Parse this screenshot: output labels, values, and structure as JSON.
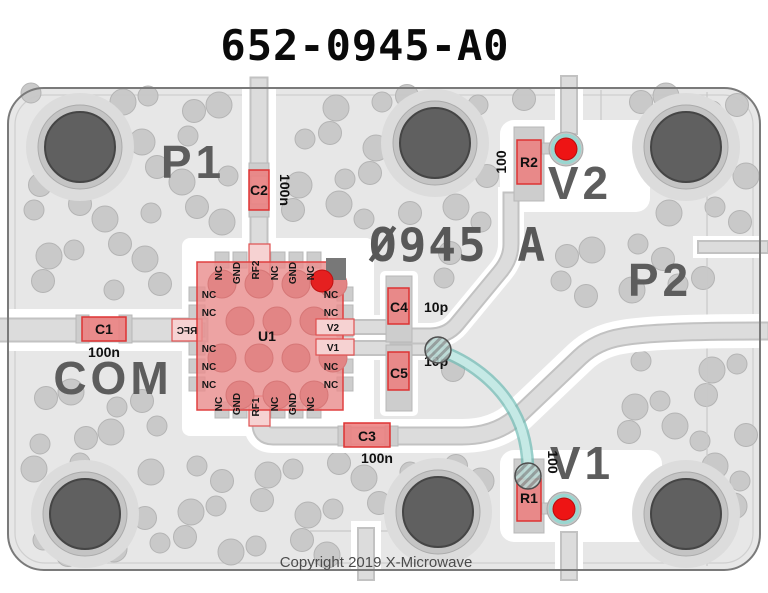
{
  "title": "652-0945-A0",
  "silkscreen": {
    "p1": "P1",
    "p2": "P2",
    "com": "COM",
    "v2": "V2",
    "v1": "V1",
    "marking": "Ø945 A"
  },
  "copyright": "Copyright 2019 X-Microwave",
  "components": {
    "u1": {
      "ref": "U1",
      "pins_top": [
        "NC",
        "GND",
        "RF2",
        "NC",
        "GND",
        "NC"
      ],
      "pins_bottom": [
        "NC",
        "GND",
        "RF1",
        "NC",
        "GND",
        "NC"
      ],
      "pins_left": [
        "NC",
        "NC",
        "RFC",
        "NC",
        "NC",
        "NC"
      ],
      "pins_right": [
        "NC",
        "NC",
        "V2",
        "V1",
        "NC",
        "NC"
      ]
    },
    "c1": {
      "ref": "C1",
      "value": "100n"
    },
    "c2": {
      "ref": "C2",
      "value": "100n"
    },
    "c3": {
      "ref": "C3",
      "value": "100n"
    },
    "c4": {
      "ref": "C4",
      "value": "10p"
    },
    "c5": {
      "ref": "C5",
      "value": "10p"
    },
    "r1": {
      "ref": "R1",
      "value": "100"
    },
    "r2": {
      "ref": "R2",
      "value": "100"
    }
  },
  "colors": {
    "board_fill": "#e7e7e7",
    "via_gray": "#c8c8c8",
    "trace_gray": "#dcdcdc",
    "component_red": "#ec7d7d",
    "component_border": "#dd3333",
    "chip_fill": "#e98f8f",
    "testpoint_red": "#ee1414",
    "wire_teal": "#7cc4bd",
    "silkscreen_gray": "#5d5d5d"
  }
}
